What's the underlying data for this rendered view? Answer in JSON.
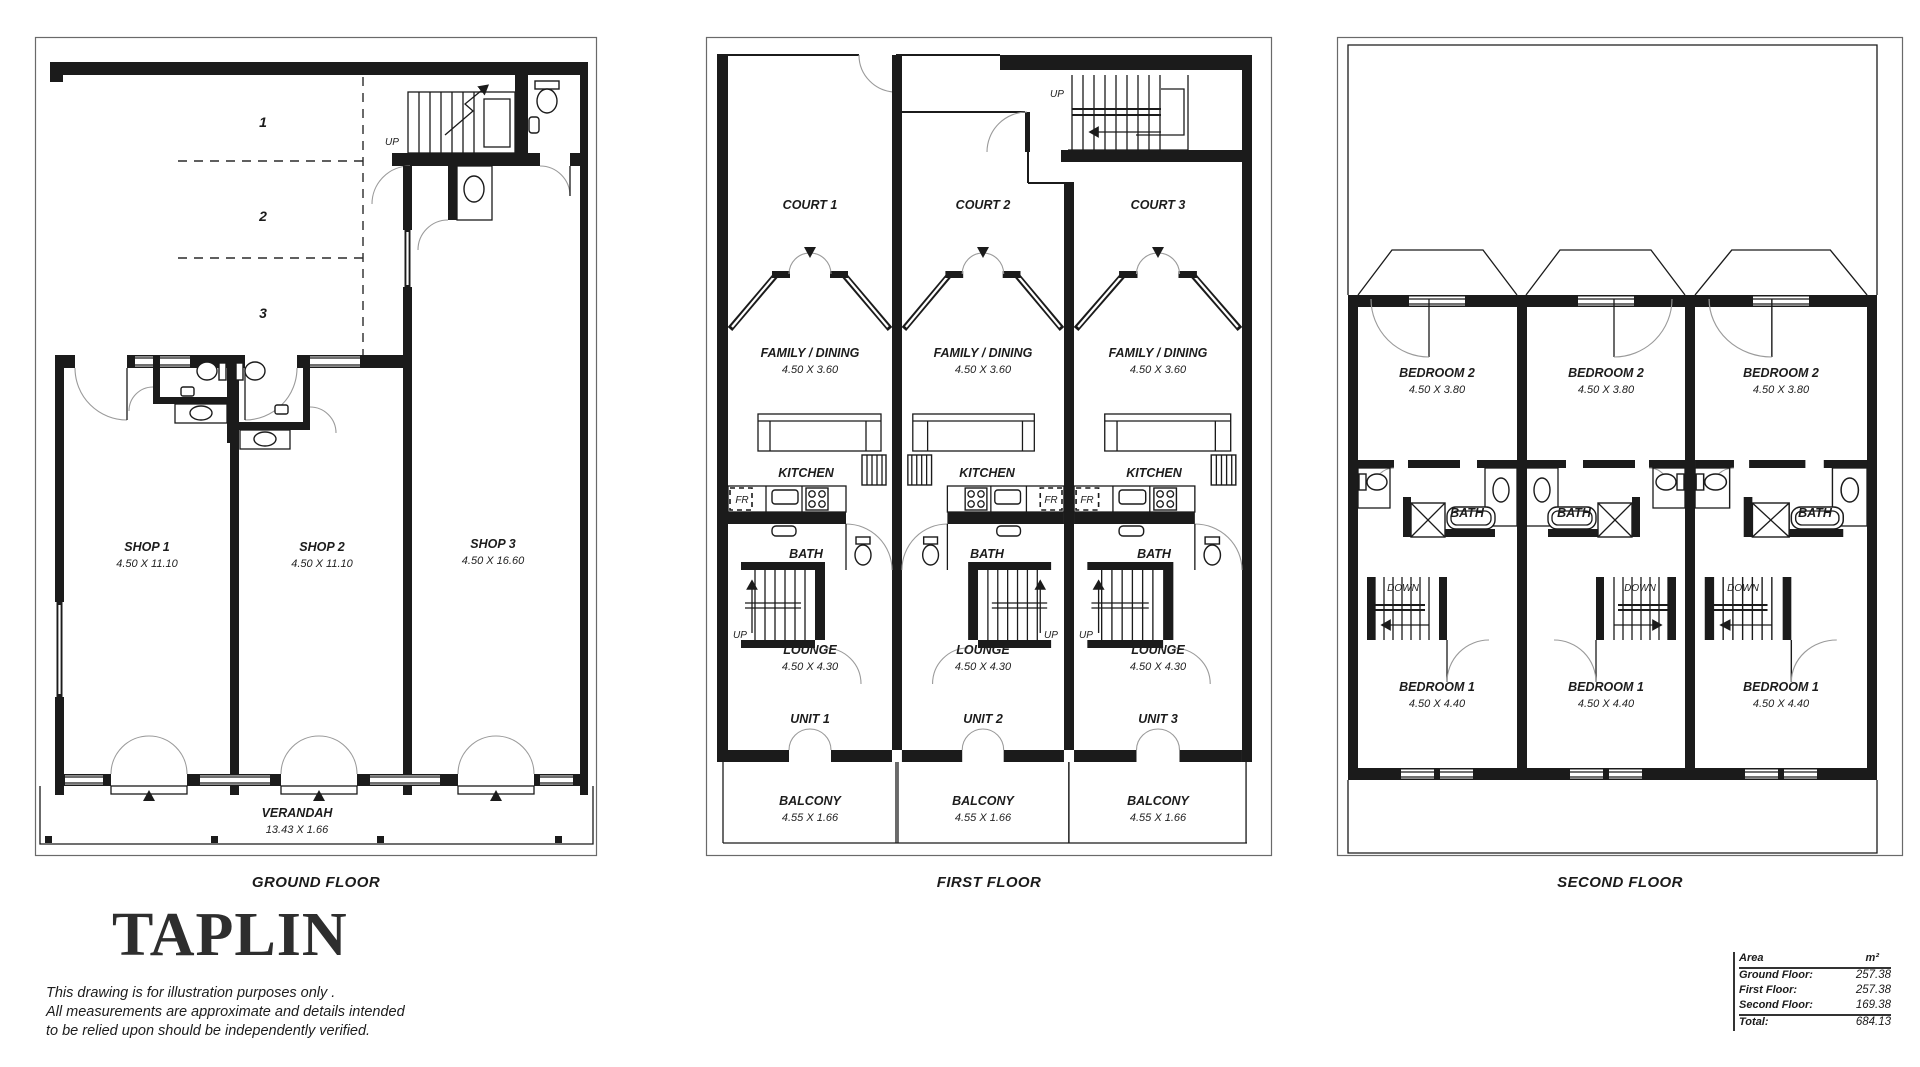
{
  "floors": {
    "ground": {
      "label": "GROUND FLOOR",
      "up_label": "UP",
      "parking_bays": [
        "1",
        "2",
        "3"
      ],
      "shops": [
        {
          "name": "SHOP 1",
          "dims": "4.50 X 11.10"
        },
        {
          "name": "SHOP 2",
          "dims": "4.50 X 11.10"
        },
        {
          "name": "SHOP 3",
          "dims": "4.50 X 16.60"
        }
      ],
      "verandah": {
        "name": "VERANDAH",
        "dims": "13.43 X 1.66"
      }
    },
    "first": {
      "label": "FIRST FLOOR",
      "up_label": "UP",
      "fr_label": "FR",
      "courts": [
        "COURT 1",
        "COURT 2",
        "COURT 3"
      ],
      "units": [
        "UNIT 1",
        "UNIT 2",
        "UNIT 3"
      ],
      "family": {
        "name": "FAMILY / DINING",
        "dims": "4.50 X 3.60"
      },
      "kitchen": {
        "name": "KITCHEN"
      },
      "bath": {
        "name": "BATH"
      },
      "lounge": {
        "name": "LOUNGE",
        "dims": "4.50 X 4.30"
      },
      "balcony": {
        "name": "BALCONY",
        "dims": "4.55 X 1.66"
      }
    },
    "second": {
      "label": "SECOND FLOOR",
      "down_label": "DOWN",
      "bedroom2": {
        "name": "BEDROOM 2",
        "dims": "4.50 X 3.80"
      },
      "bath": {
        "name": "BATH"
      },
      "bedroom1": {
        "name": "BEDROOM 1",
        "dims": "4.50 X 4.40"
      }
    }
  },
  "branding": {
    "logo": "TAPLIN",
    "disclaimer_lines": [
      "This drawing is for illustration purposes only .",
      "All measurements are approximate and details intended",
      "to be relied upon should be independently verified."
    ]
  },
  "area_table": {
    "header": {
      "label": "Area",
      "unit": "m²"
    },
    "rows": [
      {
        "label": "Ground Floor:",
        "value": "257.38"
      },
      {
        "label": "First Floor:",
        "value": "257.38"
      },
      {
        "label": "Second Floor:",
        "value": "169.38"
      }
    ],
    "total": {
      "label": "Total:",
      "value": "684.13"
    }
  }
}
